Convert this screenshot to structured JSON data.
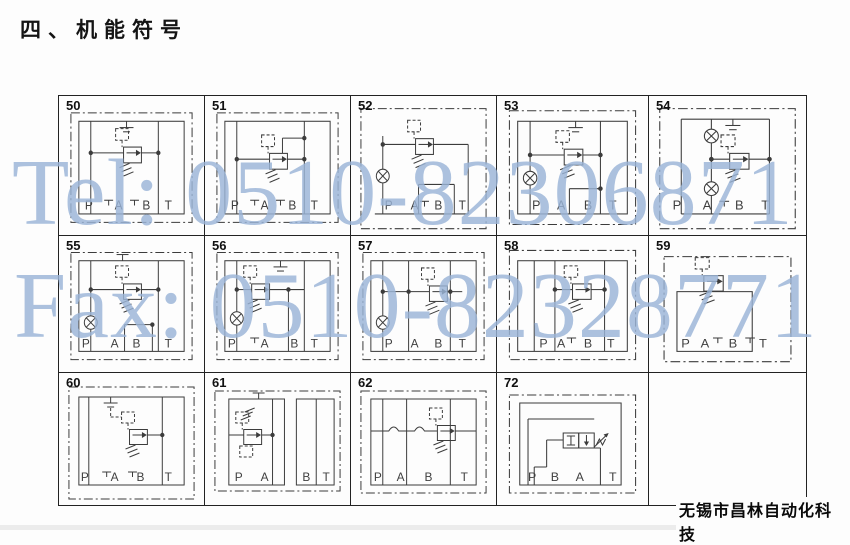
{
  "title": "四、机能符号",
  "watermark": {
    "tel": "Tel: 0510-82306871",
    "fax": "Fax: 0510-82328771",
    "color": "#9bb5d8"
  },
  "footer": {
    "company": "无锡市昌林自动化科技"
  },
  "table": {
    "rows": [
      [
        {
          "num": "50",
          "ports": [
            "P",
            "A",
            "B",
            "T"
          ],
          "symbol": "pilot-relief-valve-top-vent"
        },
        {
          "num": "51",
          "ports": [
            "P",
            "A",
            "B",
            "T"
          ],
          "symbol": "pilot-relief-valve-tank-bypass"
        },
        {
          "num": "52",
          "ports": [
            "P",
            "A",
            "B",
            "T"
          ],
          "symbol": "pilot-relief-valve-gauge-port"
        },
        {
          "num": "53",
          "ports": [
            "P",
            "A",
            "B",
            "T"
          ],
          "symbol": "pilot-relief-valve-gauge-vent"
        },
        {
          "num": "54",
          "ports": [
            "P",
            "A",
            "B",
            "T"
          ],
          "symbol": "pilot-relief-valve-two-gauges"
        }
      ],
      [
        {
          "num": "55",
          "ports": [
            "P",
            "A",
            "B",
            "T"
          ],
          "symbol": "pilot-relief-valve-gauge-b-box"
        },
        {
          "num": "56",
          "ports": [
            "P",
            "A",
            "B",
            "T"
          ],
          "symbol": "pilot-relief-valve-gauge-left"
        },
        {
          "num": "57",
          "ports": [
            "P",
            "A",
            "B",
            "T"
          ],
          "symbol": "pilot-relief-valve-cross-line"
        },
        {
          "num": "58",
          "ports": [
            "P",
            "A",
            "B",
            "T"
          ],
          "symbol": "pilot-relief-valve-right-link"
        },
        {
          "num": "59",
          "ports": [
            "P",
            "A",
            "B",
            "T"
          ],
          "symbol": "pilot-relief-valve-subblock"
        }
      ],
      [
        {
          "num": "60",
          "ports": [
            "P",
            "A",
            "B",
            "T"
          ],
          "symbol": "remote-pilot-relief-valve"
        },
        {
          "num": "61",
          "ports": [
            "P",
            "A",
            "B",
            "T"
          ],
          "symbol": "relief-valve-split-blocks"
        },
        {
          "num": "62",
          "ports": [
            "P",
            "A",
            "B",
            "T"
          ],
          "symbol": "relief-valve-flex-lines"
        },
        {
          "num": "72",
          "ports": [
            "P",
            "B",
            "A",
            "T"
          ],
          "symbol": "two-position-directional-valve"
        },
        {
          "num": "",
          "ports": [],
          "symbol": "empty"
        }
      ]
    ]
  }
}
